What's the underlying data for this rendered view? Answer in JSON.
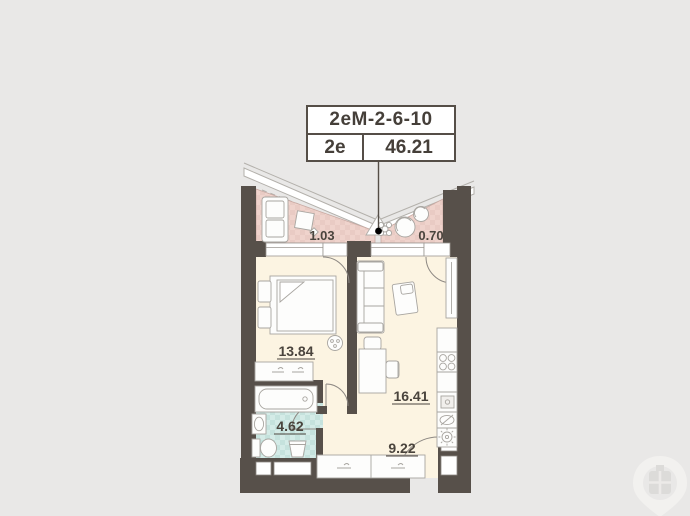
{
  "title_card": {
    "code": "2еМ-2-6-10",
    "plan_type": "2е",
    "total_area": "46.21"
  },
  "rooms": {
    "balcony_left": {
      "name": "balcony-left",
      "area": "1.03"
    },
    "balcony_right": {
      "name": "balcony-right",
      "area": "0.70"
    },
    "bedroom": {
      "name": "bedroom",
      "area": "13.84"
    },
    "living_kitchen": {
      "name": "living-kitchen",
      "area": "16.41"
    },
    "bathroom": {
      "name": "bathroom",
      "area": "4.62"
    },
    "hallway": {
      "name": "hallway",
      "area": "9.22"
    }
  },
  "colors": {
    "background": "#e9e8e7",
    "wall": "#57504a",
    "floor": "#fcf4e2",
    "balcony_floor": "#eed2cb",
    "bathroom_floor": "#cfe8e4",
    "label_text": "#453f39",
    "leader_dot": "#000000"
  },
  "icons": {
    "watermark": "location-pin-window-logo"
  }
}
